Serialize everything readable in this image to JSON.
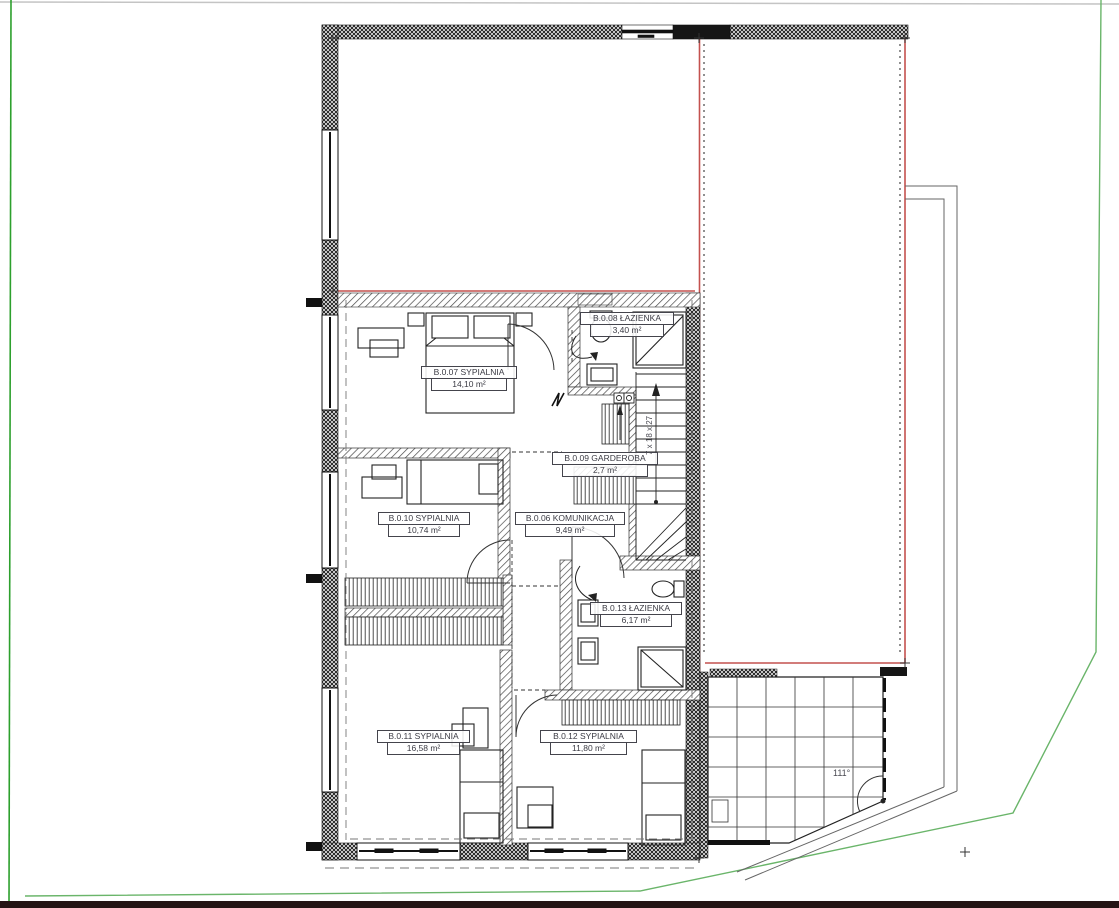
{
  "plan": {
    "rooms": [
      {
        "name": "B.0.07 SYPIALNIA",
        "area": "14,10 m²"
      },
      {
        "name": "B.0.08 ŁAZIENKA",
        "area": "3,40 m²"
      },
      {
        "name": "B.0.09 GARDEROBA",
        "area": "2,7 m²"
      },
      {
        "name": "B.0.10 SYPIALNIA",
        "area": "10,74 m²"
      },
      {
        "name": "B.0.06 KOMUNIKACJA",
        "area": "9,49 m²"
      },
      {
        "name": "B.0.13 ŁAZIENKA",
        "area": "6,17 m²"
      },
      {
        "name": "B.0.11 SYPIALNIA",
        "area": "16,58 m²"
      },
      {
        "name": "B.0.12 SYPIALNIA",
        "area": "11,80 m²"
      }
    ],
    "annotations": {
      "stairs": "7 x 18 x 27",
      "terrace_angle": "111°"
    },
    "colors": {
      "roof_outline_red": "#c4514e",
      "boundary_green": "#2da02d",
      "boundary_green_soft": "#6ab56a",
      "line_black": "#1a1a1a"
    }
  }
}
